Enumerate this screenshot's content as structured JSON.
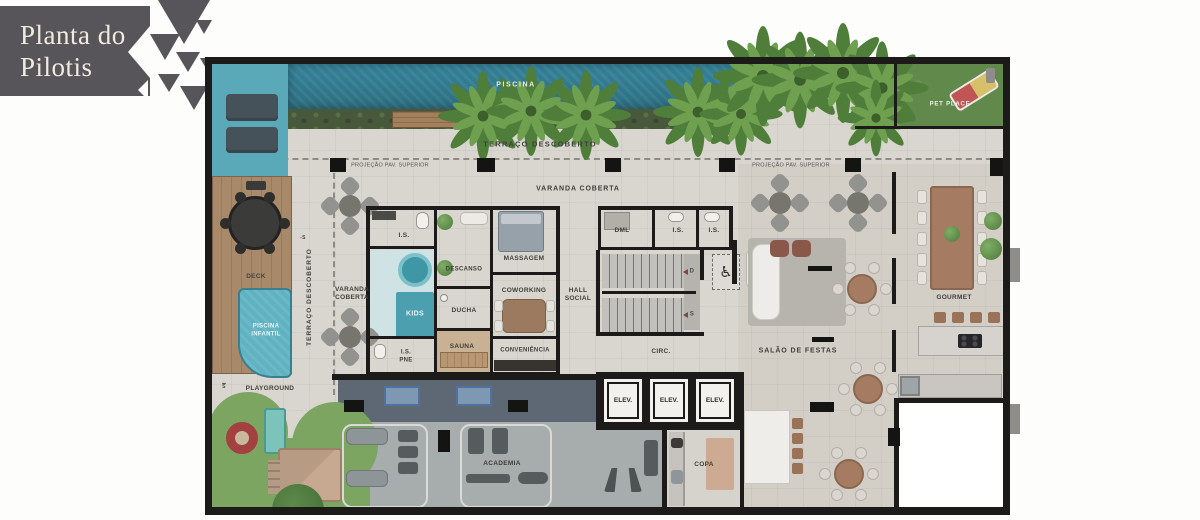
{
  "badge": {
    "line1": "Planta do",
    "line2": "Pilotis"
  },
  "outdoor": {
    "piscina": "PISCINA",
    "terraco_descoberto": "TERRAÇO DESCOBERTO",
    "projecao_pav_superior": "PROJEÇÃO PAV. SUPERIOR",
    "varanda_coberta": "VARANDA COBERTA",
    "varanda_coberta_line1": "VARANDA",
    "varanda_coberta_line2": "COBERTA",
    "pet_place": "PET PLACE",
    "deck": "DECK",
    "piscina_infantil_line1": "PISCINA",
    "piscina_infantil_line2": "INFANTIL",
    "playground": "PLAYGROUND"
  },
  "rooms": {
    "is": "I.S.",
    "is_pne_line1": "I.S.",
    "is_pne_line2": "PNE",
    "descanso": "DESCANSO",
    "massagem": "MASSAGEM",
    "kids": "KIDS",
    "ducha": "DUCHA",
    "coworking": "COWORKING",
    "sauna": "SAUNA",
    "conveniencia": "CONVENIÊNCIA",
    "hall_line1": "HALL",
    "hall_line2": "SOCIAL",
    "dml": "DML",
    "circ": "CIRC.",
    "copa": "COPA",
    "academia": "ACADEMIA",
    "salao_de_festas": "SALÃO DE FESTAS",
    "gourmet": "GOURMET",
    "elev": "ELEV."
  },
  "markers": {
    "stairs_down": "D",
    "stairs_up": "S",
    "level_minus_s": "-S",
    "level_s": "S",
    "wheelchair": "♿"
  },
  "colors": {
    "badge_bg": "#57555a",
    "badge_text": "#f0eadf",
    "wall": "#1c1b19",
    "pool": "#31798c",
    "pool_light": "#5aa9b8",
    "hedge": "#47583b",
    "grass": "#7ca562",
    "pet_grass": "#61894c",
    "wood_deck": "#a8896a",
    "gym_dark": "#5d6874",
    "gym_light": "#a7adad",
    "floor": "#d9d6d0",
    "furniture_wood": "#a57c61"
  }
}
